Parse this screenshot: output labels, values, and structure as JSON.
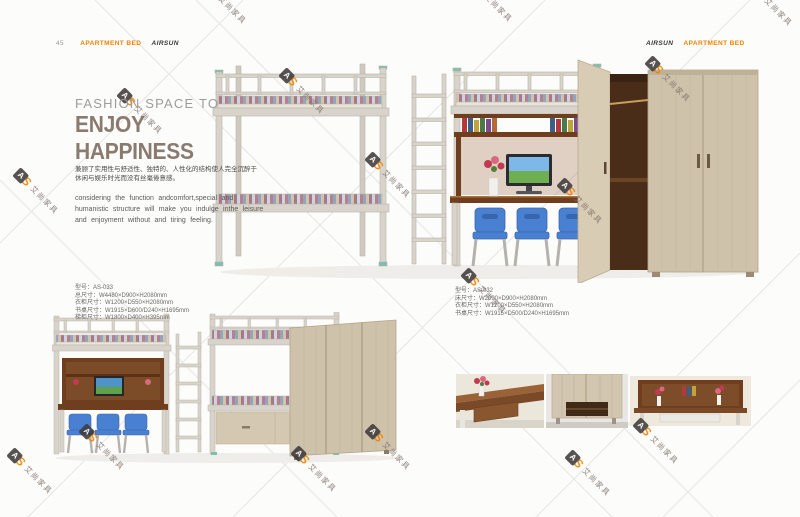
{
  "header_left": {
    "page_number": "45",
    "category": "APARTMENT BED",
    "brand": "AIRSUN"
  },
  "header_right": {
    "brand": "AIRSUN",
    "category": "APARTMENT BED"
  },
  "intro": {
    "title_line1": "FASHION SPACE TO",
    "title_line2": "ENJOY HAPPINESS",
    "cn_line1": "兼顾了实用性与舒适性、独特的、人性化的结构使人完全沉醉于",
    "cn_line2": "休闲与娱乐时光而没有丝毫倦意感。",
    "en_line1": "considering the function andcomfort,special and",
    "en_line2": "humanistic structure will make you indulge inthe leisure",
    "en_line3": "and enjoyment without and tiring feeling."
  },
  "specs_left": {
    "model": "型号：AS-033",
    "line1": "总尺寸：W4480×D900×H2080mm",
    "line2": "衣柜尺寸：W1200×D550×H2080mm",
    "line3": "书桌尺寸：W1915×D600/D240×H1695mm",
    "line4": "梯柜尺寸：W1800×D400×H395mm"
  },
  "specs_right": {
    "model": "型号：AS-032",
    "line1": "床尺寸：W2090×D900×H2080mm",
    "line2": "衣柜尺寸：W1200×D550×H2080mm",
    "line3": "书桌尺寸：W1915×D500/D240×H1695mm"
  },
  "watermark": {
    "logo_a": "A",
    "logo_s": "S",
    "company": "艾尚家具"
  },
  "colors": {
    "accent_orange": "#ef8200",
    "title_taupe": "#8b7b6e",
    "wood_light": "#cfc2ab",
    "wood_dark": "#6e3e1f",
    "chair_blue": "#4a80d2",
    "metal_frame": "#d8d4cb"
  }
}
